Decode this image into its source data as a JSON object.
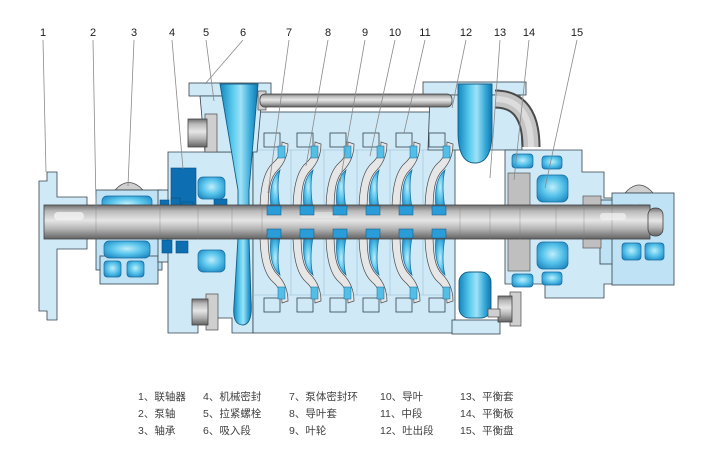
{
  "callouts": [
    "1",
    "2",
    "3",
    "4",
    "5",
    "6",
    "7",
    "8",
    "9",
    "10",
    "11",
    "12",
    "13",
    "14",
    "15"
  ],
  "legend": {
    "items": [
      {
        "label": "1、联轴器"
      },
      {
        "label": "2、泵轴"
      },
      {
        "label": "3、轴承"
      },
      {
        "label": "4、机械密封"
      },
      {
        "label": "5、拉紧螺栓"
      },
      {
        "label": "6、吸入段"
      },
      {
        "label": "7、泵体密封环"
      },
      {
        "label": "8、导叶套"
      },
      {
        "label": "9、叶轮"
      },
      {
        "label": "10、导叶"
      },
      {
        "label": "11、中段"
      },
      {
        "label": "12、吐出段"
      },
      {
        "label": "13、平衡套"
      },
      {
        "label": "14、平衡板"
      },
      {
        "label": "15、平衡盘"
      }
    ]
  },
  "colors": {
    "background": "#ffffff",
    "casing": "#cfe9f7",
    "casing2": "#bfe2f4",
    "part_blue": "#2a9cd8",
    "part_blue_dark": "#0d6fb2",
    "funnel_blue": "#2aa6d8",
    "metal_gray": "#b9b9b9",
    "outline": "#33414c",
    "leader": "#8a8a8a",
    "text": "#1c1c1c",
    "legend_text": "#3f3f3f"
  }
}
